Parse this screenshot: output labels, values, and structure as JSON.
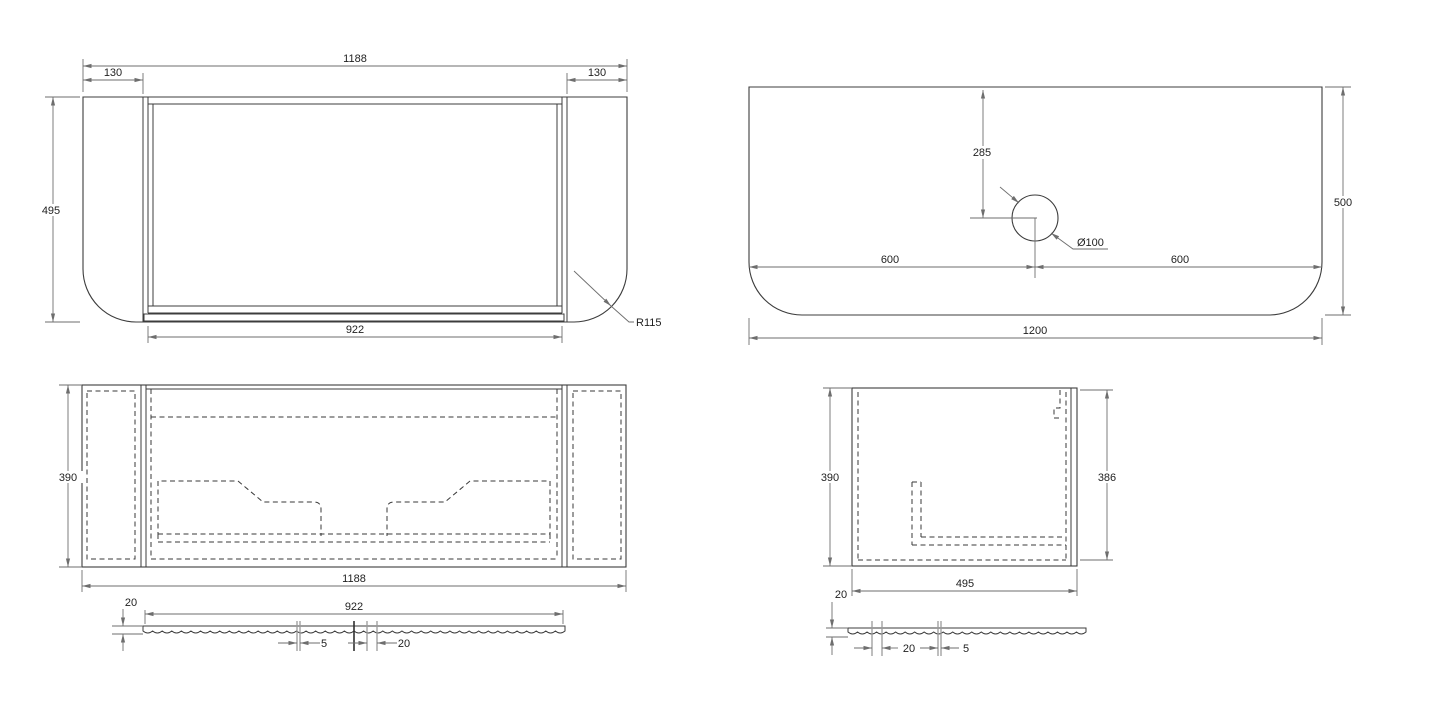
{
  "document": {
    "type": "technical-drawing",
    "background": "#ffffff",
    "line_color": "#3c3c3c",
    "dim_color": "#6e6e6e",
    "hidden_line_style": "dashed"
  },
  "views": {
    "front": {
      "total_width": "1188",
      "left_panel": "130",
      "right_panel": "130",
      "height": "495",
      "opening_width": "922",
      "corner_radius": "R115"
    },
    "plan": {
      "hole_offset": "285",
      "hole_diameter": "Ø100",
      "left_half": "600",
      "right_half": "600",
      "depth": "500",
      "total_width": "1200"
    },
    "section_front": {
      "depth": "390",
      "total_width": "1188",
      "slat_thickness": "20",
      "slat_width": "922",
      "flute_width": "5",
      "flute_pitch": "20"
    },
    "section_side": {
      "outer_depth": "390",
      "inner_depth": "386",
      "width": "495",
      "slat_thickness": "20",
      "flute_pitch": "20",
      "flute_width": "5"
    }
  }
}
